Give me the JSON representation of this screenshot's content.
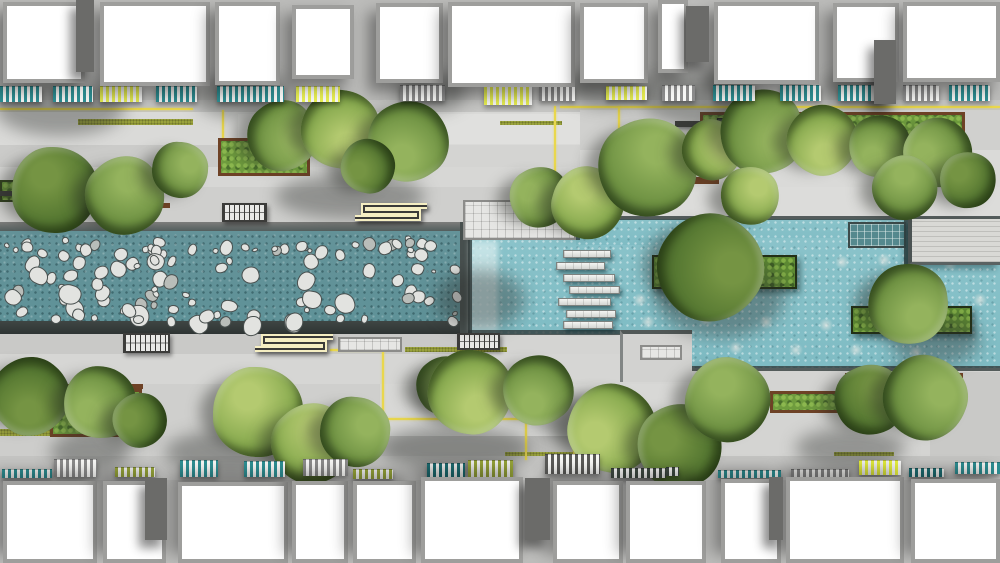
{
  "meta": {
    "canvas": {
      "w": 1000,
      "h": 563
    }
  },
  "palette": {
    "background": "#bcbcba",
    "park_base": "#d4d4d2",
    "channel_water": "#5f9298",
    "pool_water": "#8ac3ca",
    "yellow_line": "#e9d74d",
    "grass": "#9aa23c",
    "planter_rim_brown": "#6e4226",
    "wall_dark": "#454d4c",
    "awning_colors": {
      "teal": "#2e8f93",
      "gray": "#8b8b8b",
      "yellow": "#e7ee52",
      "olive": "#99a73a",
      "darkteal": "#1d6f74",
      "darkgray": "#5a5a58",
      "yellowbright": "#e8f23e",
      "darkstripe": "#3f4a42"
    },
    "tree_tones": [
      [
        "#55792f",
        "#74953f",
        "#35511c"
      ],
      [
        "#6f9440",
        "#93b459",
        "#44672a"
      ],
      [
        "#87ab4b",
        "#b3cb6c",
        "#547a2d"
      ]
    ]
  },
  "buildings": {
    "top": [
      [
        3,
        2,
        82,
        81
      ],
      [
        100,
        2,
        110,
        84
      ],
      [
        215,
        2,
        65,
        83
      ],
      [
        292,
        5,
        62,
        74
      ],
      [
        376,
        3,
        67,
        80
      ],
      [
        448,
        2,
        127,
        85
      ],
      [
        580,
        3,
        68,
        80
      ],
      [
        658,
        0,
        30,
        73
      ],
      [
        714,
        2,
        105,
        82
      ],
      [
        833,
        3,
        66,
        79
      ],
      [
        903,
        2,
        97,
        80
      ]
    ],
    "bottom": [
      [
        3,
        481,
        94,
        82
      ],
      [
        103,
        481,
        63,
        82
      ],
      [
        178,
        482,
        110,
        81
      ],
      [
        292,
        481,
        56,
        82
      ],
      [
        353,
        481,
        63,
        82
      ],
      [
        421,
        477,
        102,
        86
      ],
      [
        553,
        481,
        70,
        82
      ],
      [
        626,
        481,
        80,
        82
      ],
      [
        721,
        479,
        60,
        84
      ],
      [
        786,
        477,
        118,
        86
      ],
      [
        911,
        479,
        89,
        84
      ]
    ],
    "dark_blocks": [
      [
        76,
        0,
        18,
        72
      ],
      [
        686,
        6,
        23,
        56
      ],
      [
        874,
        40,
        22,
        64
      ],
      [
        145,
        478,
        22,
        62
      ],
      [
        525,
        478,
        25,
        62
      ],
      [
        769,
        477,
        14,
        63
      ]
    ]
  },
  "awnings": {
    "top": [
      [
        0,
        86,
        42,
        16,
        "teal"
      ],
      [
        53,
        86,
        40,
        16,
        "teal"
      ],
      [
        100,
        86,
        42,
        16,
        "yellow"
      ],
      [
        156,
        86,
        41,
        16,
        "teal"
      ],
      [
        217,
        86,
        67,
        16,
        "teal"
      ],
      [
        296,
        86,
        44,
        16,
        "yellow"
      ],
      [
        400,
        85,
        45,
        16,
        "gray"
      ],
      [
        484,
        85,
        48,
        20,
        "yellow"
      ],
      [
        539,
        85,
        36,
        16,
        "gray"
      ],
      [
        606,
        86,
        41,
        14,
        "yellow"
      ],
      [
        662,
        85,
        33,
        16,
        "gray"
      ],
      [
        713,
        85,
        42,
        16,
        "teal"
      ],
      [
        780,
        85,
        41,
        16,
        "teal"
      ],
      [
        838,
        85,
        43,
        16,
        "teal"
      ],
      [
        903,
        85,
        36,
        16,
        "gray"
      ],
      [
        949,
        85,
        41,
        16,
        "teal"
      ]
    ],
    "bottom": [
      [
        2,
        469,
        50,
        9,
        "teal"
      ],
      [
        54,
        459,
        43,
        18,
        "gray"
      ],
      [
        115,
        467,
        40,
        10,
        "olive"
      ],
      [
        180,
        460,
        38,
        17,
        "teal"
      ],
      [
        244,
        461,
        41,
        16,
        "teal"
      ],
      [
        303,
        459,
        45,
        17,
        "gray"
      ],
      [
        353,
        469,
        40,
        10,
        "olive"
      ],
      [
        427,
        463,
        38,
        14,
        "darkteal"
      ],
      [
        468,
        460,
        45,
        17,
        "olive"
      ],
      [
        545,
        454,
        55,
        20,
        "darkgray"
      ],
      [
        611,
        468,
        55,
        10,
        "darkstripe"
      ],
      [
        666,
        467,
        13,
        9,
        "darkstripe"
      ],
      [
        718,
        470,
        63,
        8,
        "teal"
      ],
      [
        791,
        469,
        58,
        8,
        "gray"
      ],
      [
        859,
        460,
        42,
        15,
        "yellowbright"
      ],
      [
        909,
        468,
        35,
        9,
        "darkteal"
      ],
      [
        955,
        462,
        45,
        12,
        "teal"
      ]
    ]
  },
  "park": {
    "base": [
      0,
      100,
      1000,
      380
    ],
    "bands": [
      [
        0,
        100,
        1000,
        12,
        "#c5c5c3",
        "speckle"
      ],
      [
        0,
        112,
        580,
        33,
        "#dadad8",
        "speckle"
      ],
      [
        238,
        114,
        342,
        30,
        "#e0e0de",
        "plankv"
      ],
      [
        580,
        110,
        420,
        40,
        "#d0d0ce",
        "speckle"
      ],
      [
        0,
        145,
        240,
        22,
        "#cbcbc9",
        "stripesh"
      ],
      [
        0,
        167,
        580,
        20,
        "#d7d7d5",
        "speckle"
      ],
      [
        580,
        150,
        420,
        38,
        "#dadad8",
        "plankv"
      ],
      [
        0,
        187,
        576,
        35,
        "#cfcfcd",
        "speckle"
      ],
      [
        576,
        187,
        424,
        30,
        "#dcdcda",
        "plankh"
      ],
      [
        0,
        332,
        470,
        22,
        "#c9c9c7",
        "stripesh"
      ],
      [
        0,
        354,
        1000,
        30,
        "#d6d6d4",
        "speckle"
      ],
      [
        0,
        384,
        380,
        52,
        "#cfcfcd",
        "speckle"
      ],
      [
        380,
        384,
        330,
        52,
        "#d8d8d6",
        "speckle"
      ],
      [
        380,
        436,
        330,
        20,
        "#bbbbb9",
        "plankv"
      ],
      [
        0,
        436,
        380,
        20,
        "#cdcdcb",
        "speckle"
      ],
      [
        710,
        370,
        290,
        66,
        "#d4d4d2",
        "speckle"
      ],
      [
        930,
        372,
        70,
        88,
        "#c9c9c7",
        "plankh"
      ],
      [
        0,
        456,
        1000,
        24,
        "#c4c4c2",
        "speckle"
      ]
    ],
    "bands_over_water": [
      [
        620,
        330,
        72,
        52,
        "#d2d2d0",
        "speckle"
      ]
    ],
    "grid_panels": [
      [
        338,
        337,
        64,
        15
      ],
      [
        640,
        345,
        42,
        15
      ],
      [
        463,
        200,
        113,
        40
      ]
    ],
    "grass_strips": [
      [
        78,
        119,
        115,
        6
      ],
      [
        500,
        121,
        62,
        4
      ],
      [
        405,
        347,
        102,
        5
      ],
      [
        505,
        452,
        163,
        4
      ],
      [
        834,
        452,
        60,
        4
      ],
      [
        0,
        429,
        118,
        7
      ]
    ],
    "planter_rims": [
      [
        75,
        203,
        95,
        5
      ],
      [
        617,
        177,
        102,
        7
      ],
      [
        801,
        141,
        34,
        5
      ],
      [
        50,
        384,
        93,
        5
      ],
      [
        845,
        373,
        118,
        5
      ],
      [
        432,
        386,
        56,
        4
      ]
    ],
    "hedges": [
      [
        218,
        138,
        92,
        38,
        1
      ],
      [
        0,
        180,
        80,
        22,
        0
      ],
      [
        700,
        112,
        265,
        46,
        1
      ],
      [
        50,
        389,
        92,
        48,
        1
      ],
      [
        845,
        378,
        115,
        38,
        1
      ],
      [
        432,
        390,
        55,
        21,
        1
      ],
      [
        770,
        391,
        108,
        22,
        1
      ]
    ],
    "dark_planters": [
      [
        717,
        118,
        24,
        46
      ],
      [
        872,
        122,
        16,
        40
      ]
    ],
    "dark_benches": [
      [
        0,
        191,
        20,
        5
      ],
      [
        675,
        121,
        42,
        6
      ]
    ],
    "yellow_lines": [
      [
        0,
        108,
        193,
        2
      ],
      [
        222,
        110,
        2,
        62
      ],
      [
        222,
        170,
        50,
        2
      ],
      [
        560,
        106,
        440,
        2
      ],
      [
        554,
        106,
        2,
        81
      ],
      [
        618,
        106,
        2,
        60
      ],
      [
        330,
        349,
        54,
        2
      ],
      [
        382,
        349,
        2,
        71
      ],
      [
        382,
        418,
        143,
        2
      ],
      [
        525,
        418,
        2,
        42
      ],
      [
        573,
        420,
        2,
        36
      ]
    ]
  },
  "water": {
    "channel": {
      "x": 0,
      "y": 222,
      "w": 478,
      "top_wall_h": 9,
      "water_h": 90,
      "bottom_wall_y": 321,
      "bottom_wall_h": 13,
      "end_wall": [
        460,
        222,
        16,
        112
      ]
    },
    "pools": [
      [
        470,
        238,
        210,
        96
      ],
      [
        576,
        219,
        424,
        26
      ],
      [
        676,
        238,
        324,
        130
      ]
    ],
    "turbulence": [
      470,
      240,
      28,
      92
    ],
    "edges": [
      [
        576,
        216,
        424,
        4
      ],
      [
        463,
        236,
        117,
        4
      ],
      [
        468,
        236,
        4,
        99
      ],
      [
        468,
        330,
        212,
        5
      ],
      [
        676,
        366,
        324,
        5
      ],
      [
        904,
        219,
        4,
        46
      ]
    ],
    "grid_pool": [
      848,
      222,
      58,
      26
    ],
    "deck": [
      908,
      219,
      92,
      46
    ],
    "islands": [
      [
        652,
        255,
        145,
        34
      ],
      [
        851,
        306,
        121,
        28
      ]
    ],
    "stepping_planks": [
      [
        563,
        250,
        48,
        8
      ],
      [
        556,
        262,
        49,
        8
      ],
      [
        563,
        274,
        52,
        8
      ],
      [
        569,
        286,
        51,
        8
      ],
      [
        558,
        298,
        53,
        8
      ],
      [
        566,
        310,
        50,
        8
      ],
      [
        563,
        321,
        50,
        8
      ]
    ],
    "stepping_dots": [
      [
        648,
        322
      ],
      [
        676,
        346
      ],
      [
        706,
        320
      ],
      [
        736,
        348
      ],
      [
        766,
        322
      ],
      [
        796,
        350
      ],
      [
        826,
        325
      ],
      [
        856,
        350
      ],
      [
        886,
        325
      ],
      [
        916,
        352
      ],
      [
        946,
        328
      ],
      [
        700,
        262
      ],
      [
        742,
        264
      ],
      [
        842,
        262
      ],
      [
        884,
        260
      ],
      [
        950,
        264
      ],
      [
        640,
        300
      ],
      [
        980,
        300
      ]
    ],
    "stone_field": {
      "x": 3,
      "y": 236,
      "w": 450,
      "h": 80,
      "count": 115,
      "seed": 9
    }
  },
  "furniture": {
    "stairs": [
      [
        222,
        203,
        45,
        19
      ],
      [
        123,
        333,
        47,
        20
      ],
      [
        457,
        333,
        43,
        17
      ]
    ],
    "s_benches": [
      [
        352,
        202,
        78,
        20
      ],
      [
        252,
        333,
        84,
        20
      ]
    ]
  },
  "vegetation": {
    "shadow_blobs": [
      [
        60,
        108,
        130,
        55
      ],
      [
        245,
        96,
        100,
        45
      ],
      [
        430,
        92,
        70,
        40
      ],
      [
        610,
        88,
        90,
        40
      ],
      [
        700,
        98,
        120,
        55
      ],
      [
        862,
        92,
        80,
        40
      ],
      [
        350,
        196,
        150,
        45
      ],
      [
        720,
        295,
        130,
        85
      ],
      [
        480,
        300,
        90,
        60
      ],
      [
        230,
        452,
        130,
        45
      ],
      [
        455,
        448,
        150,
        45
      ],
      [
        650,
        452,
        120,
        45
      ],
      [
        850,
        448,
        110,
        40
      ],
      [
        90,
        452,
        80,
        40
      ],
      [
        580,
        418,
        90,
        45
      ],
      [
        935,
        340,
        90,
        50
      ]
    ],
    "trees": [
      [
        55,
        190,
        86,
        0
      ],
      [
        125,
        196,
        78,
        1
      ],
      [
        180,
        170,
        56,
        1
      ],
      [
        282,
        136,
        70,
        1
      ],
      [
        340,
        129,
        78,
        2
      ],
      [
        408,
        141,
        80,
        1
      ],
      [
        368,
        166,
        54,
        0
      ],
      [
        540,
        197,
        60,
        1
      ],
      [
        588,
        203,
        72,
        2
      ],
      [
        648,
        168,
        98,
        1
      ],
      [
        712,
        150,
        60,
        2
      ],
      [
        762,
        132,
        84,
        1
      ],
      [
        822,
        140,
        70,
        2
      ],
      [
        880,
        146,
        62,
        1
      ],
      [
        938,
        152,
        68,
        1
      ],
      [
        968,
        180,
        56,
        0
      ],
      [
        905,
        188,
        64,
        1
      ],
      [
        750,
        196,
        58,
        2
      ],
      [
        710,
        268,
        106,
        0
      ],
      [
        908,
        304,
        80,
        1
      ],
      [
        30,
        396,
        78,
        0
      ],
      [
        100,
        402,
        72,
        1
      ],
      [
        140,
        420,
        54,
        0
      ],
      [
        258,
        412,
        90,
        2
      ],
      [
        312,
        444,
        80,
        2
      ],
      [
        355,
        432,
        70,
        1
      ],
      [
        445,
        386,
        58,
        1
      ],
      [
        470,
        392,
        84,
        2
      ],
      [
        538,
        390,
        70,
        1
      ],
      [
        612,
        428,
        88,
        2
      ],
      [
        680,
        446,
        84,
        0
      ],
      [
        728,
        400,
        84,
        1
      ],
      [
        870,
        400,
        70,
        0
      ],
      [
        925,
        398,
        84,
        1
      ]
    ]
  }
}
